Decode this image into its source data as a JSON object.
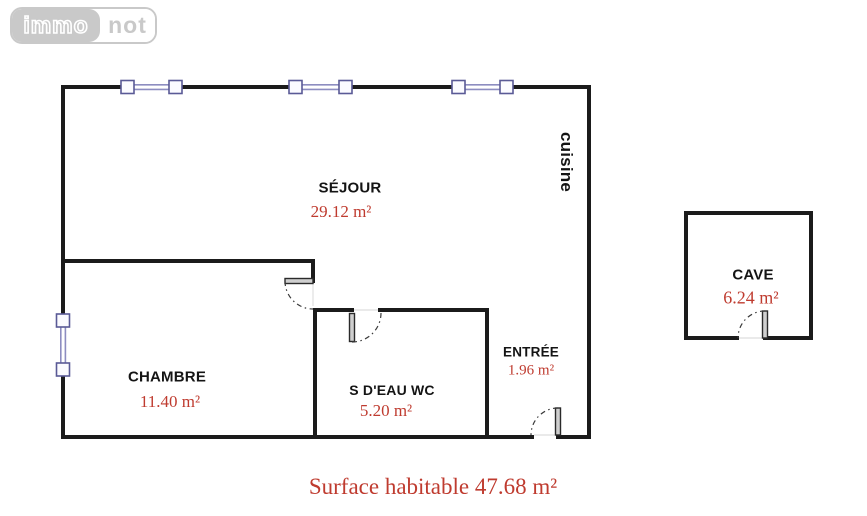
{
  "logo": {
    "immo": "immo",
    "not": "not"
  },
  "rooms": {
    "cuisine": {
      "label": "cuisine"
    },
    "sejour": {
      "label": "SÉJOUR",
      "area": "29.12 m²"
    },
    "chambre": {
      "label": "CHAMBRE",
      "area": "11.40 m²"
    },
    "sdeau": {
      "label": "S D'EAU WC",
      "area": "5.20 m²"
    },
    "entree": {
      "label": "ENTRÉE",
      "area": "1.96 m²"
    },
    "cave": {
      "label": "CAVE",
      "area": "6.24 m²"
    }
  },
  "caption": "Surface habitable 47.68 m²",
  "colors": {
    "area_text": "#bf3b2f",
    "wall": "#1b1b1b",
    "window_frame": "#5a5a96",
    "window_glass": "#8d8dc0",
    "logo_gray": "#c9c9c9"
  }
}
